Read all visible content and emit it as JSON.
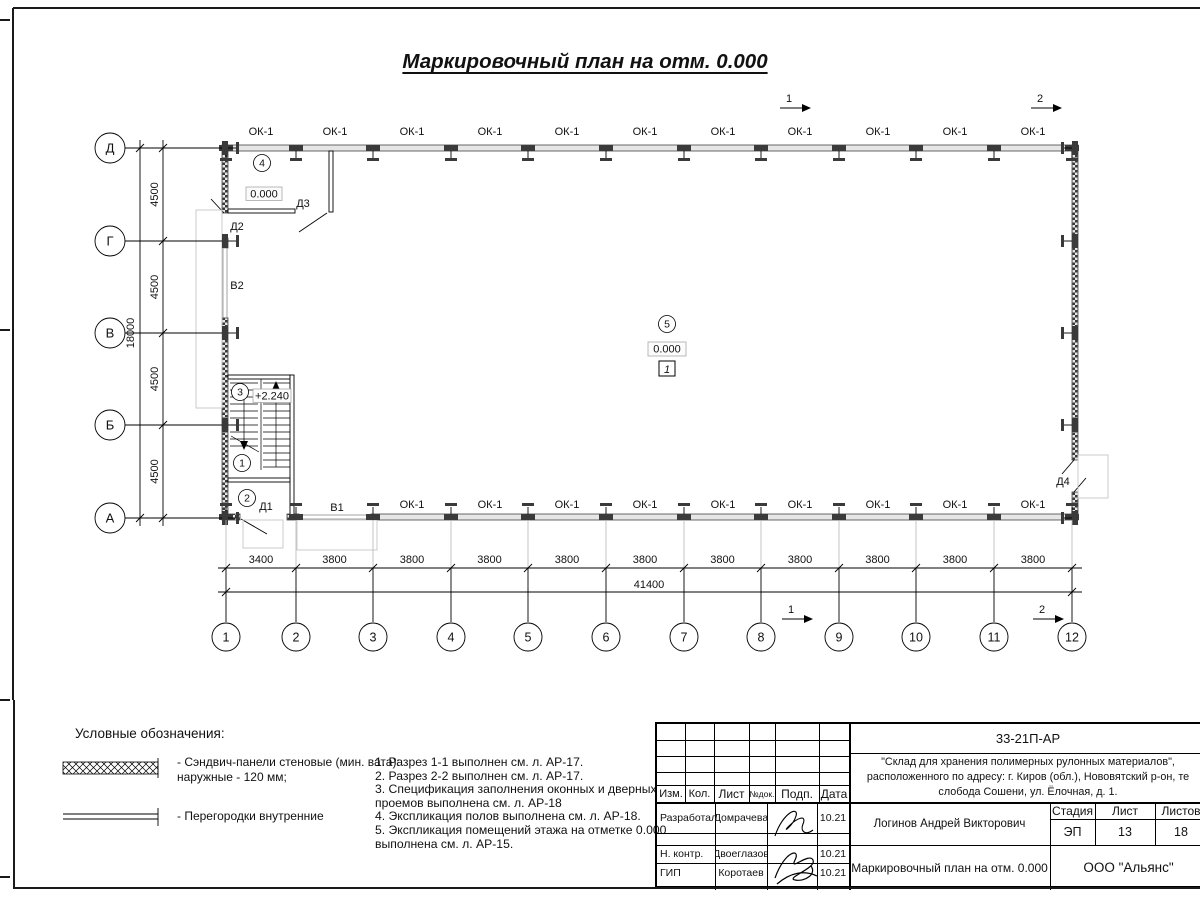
{
  "colors": {
    "wall_fill": "#e6e6e6",
    "line": "#000000",
    "light_line": "#c6c6c6"
  },
  "title": "Маркировочный план на отм. 0.000",
  "plan": {
    "window_label": "ОК-1",
    "elev_zero": "0.000",
    "elev_stair": "+2.240",
    "floor_mark": "1",
    "room_markers": [
      "1",
      "2",
      "3",
      "4",
      "5"
    ],
    "doors": {
      "d1": "Д1",
      "d2": "Д2",
      "d3": "Д3",
      "d4": "Д4",
      "v1": "В1",
      "v2": "В2"
    },
    "section_marks": {
      "s1": "1",
      "s2": "2"
    }
  },
  "axes": {
    "vertical": [
      "Д",
      "Г",
      "В",
      "Б",
      "А"
    ],
    "horizontal": [
      "1",
      "2",
      "3",
      "4",
      "5",
      "6",
      "7",
      "8",
      "9",
      "10",
      "11",
      "12"
    ],
    "dim_left_segments": [
      "4500",
      "4500",
      "4500",
      "4500"
    ],
    "dim_left_total": "18000",
    "dim_bottom_segments": [
      "3400",
      "3800",
      "3800",
      "3800",
      "3800",
      "3800",
      "3800",
      "3800",
      "3800",
      "3800",
      "3800"
    ],
    "dim_bottom_total": "41400"
  },
  "legend": {
    "heading": "Условные обозначения:",
    "item1_line1": "- Сэндвич-панели стеновые (мин. вата):",
    "item1_line2": "наружные - 120 мм;",
    "item2": "- Перегородки внутренние"
  },
  "notes": [
    "1. Разрез 1-1 выполнен см. л. АР-17.",
    "2. Разрез 2-2 выполнен см. л. АР-17.",
    "3. Спецификация заполнения оконных и дверных проемов выполнена см. л. АР-18",
    "4. Экспликация полов выполнена см. л. АР-18.",
    "5. Экспликация помещений этажа на отметке 0.000 выполнена см. л. АР-15."
  ],
  "titleblock": {
    "doc_code": "33-21П-АР",
    "project_line1": "\"Склад для хранения полимерных рулонных материалов\",",
    "project_line2": "расположенного по адресу: г. Киров (обл.), Нововятский р-он, те",
    "project_line3": "слобода Сошени, ул. Ёлочная, д. 1.",
    "header_cells": [
      "Изм.",
      "Кол.",
      "Лист",
      "№док.",
      "Подп.",
      "Дата"
    ],
    "rows": [
      {
        "role": "Разработал",
        "name": "Домрачева",
        "date": "10.21"
      },
      {
        "role": "Н. контр.",
        "name": "Двоеглазов",
        "date": "10.21"
      },
      {
        "role": "ГИП",
        "name": "Коротаев",
        "date": "10.21"
      }
    ],
    "approver": "Логинов Андрей Викторович",
    "stage_label": "Стадия",
    "sheet_label": "Лист",
    "sheets_label": "Листов",
    "stage_value": "ЭП",
    "sheet_value": "13",
    "sheets_value": "18",
    "sheet_title": "Маркировочный план на отм. 0.000",
    "company": "ООО \"Альянс\""
  }
}
